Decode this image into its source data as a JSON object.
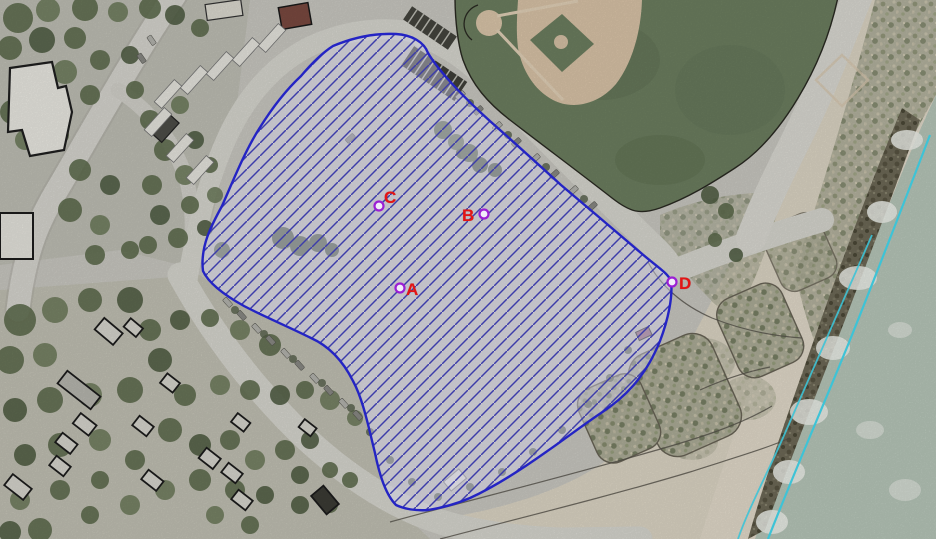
{
  "overlay": {
    "outline_color": "#2424c4",
    "hatch_color": "#3d3daa",
    "fill_tint": "rgba(214,214,240,0.42)"
  },
  "markers": {
    "ring_color": "#9b1fd4",
    "ring_fill": "#f2ecfa",
    "label_color": "#e41414",
    "points": [
      {
        "label": "C",
        "x": 379,
        "y": 206,
        "label_dx": 5,
        "label_dy": -3
      },
      {
        "label": "B",
        "x": 484,
        "y": 214,
        "label_dx": -22,
        "label_dy": 7
      },
      {
        "label": "A",
        "x": 400,
        "y": 288,
        "label_dx": 6,
        "label_dy": 7
      },
      {
        "label": "D",
        "x": 672,
        "y": 282,
        "label_dx": 7,
        "label_dy": 7
      }
    ]
  },
  "shoreline": {
    "line_color": "#3ec3d6"
  }
}
